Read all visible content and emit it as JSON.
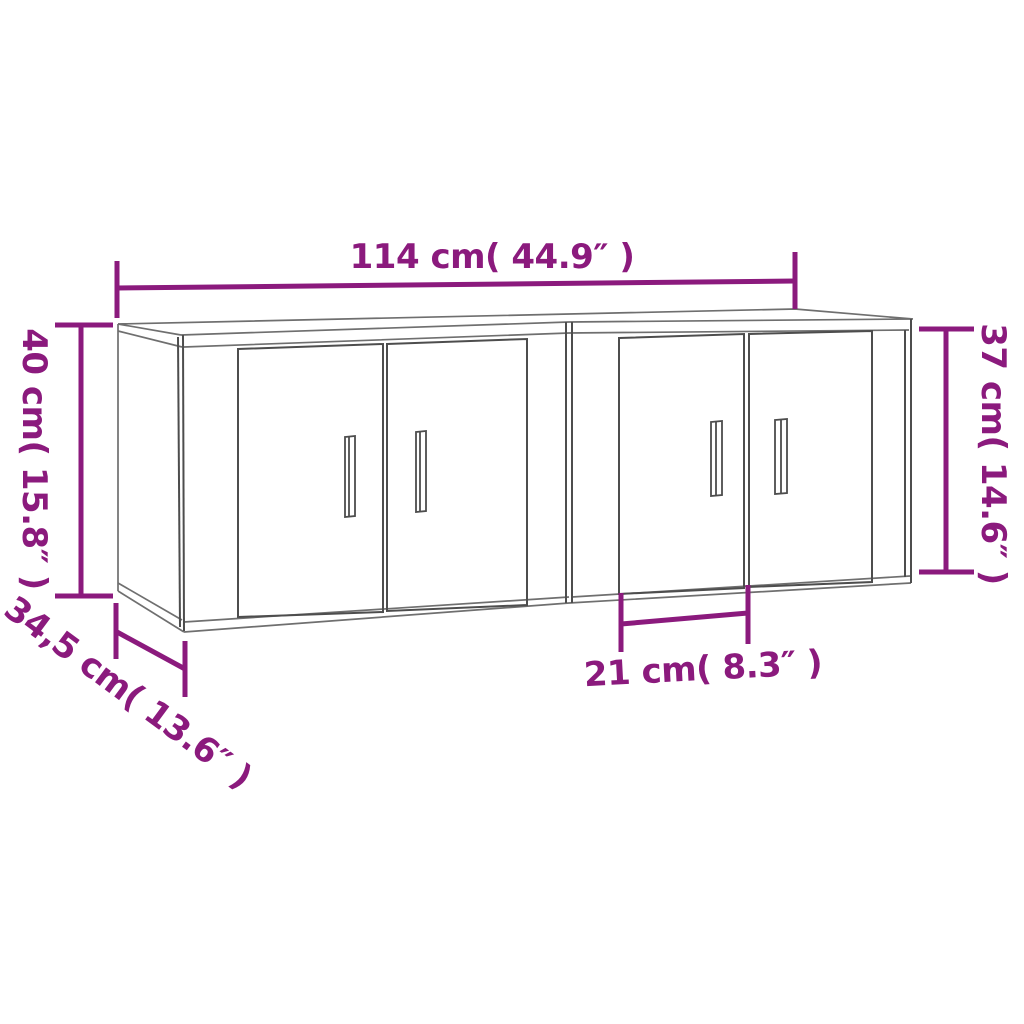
{
  "background": "#ffffff",
  "accent_color": "#8b1a7d",
  "line_color_light": "#6f6f6f",
  "line_color_dark": "#4d4d4d",
  "measurements": [
    {
      "id": "overall-width",
      "value_cm": "114",
      "value_inch": "44.9",
      "label": "114 cm( 44.9″ )"
    },
    {
      "id": "left-height",
      "value_cm": "40",
      "value_inch": "15.8",
      "label": "40 cm( 15.8″ )"
    },
    {
      "id": "right-height",
      "value_cm": "37",
      "value_inch": "14.6",
      "label": "37 cm( 14.6″ )"
    },
    {
      "id": "depth",
      "value_cm": "34,5",
      "value_inch": "13.6",
      "label": "34,5 cm( 13.6″ )"
    },
    {
      "id": "door-section-width",
      "value_cm": "21",
      "value_inch": "8.3",
      "label": "21 cm( 8.3″ )"
    }
  ]
}
